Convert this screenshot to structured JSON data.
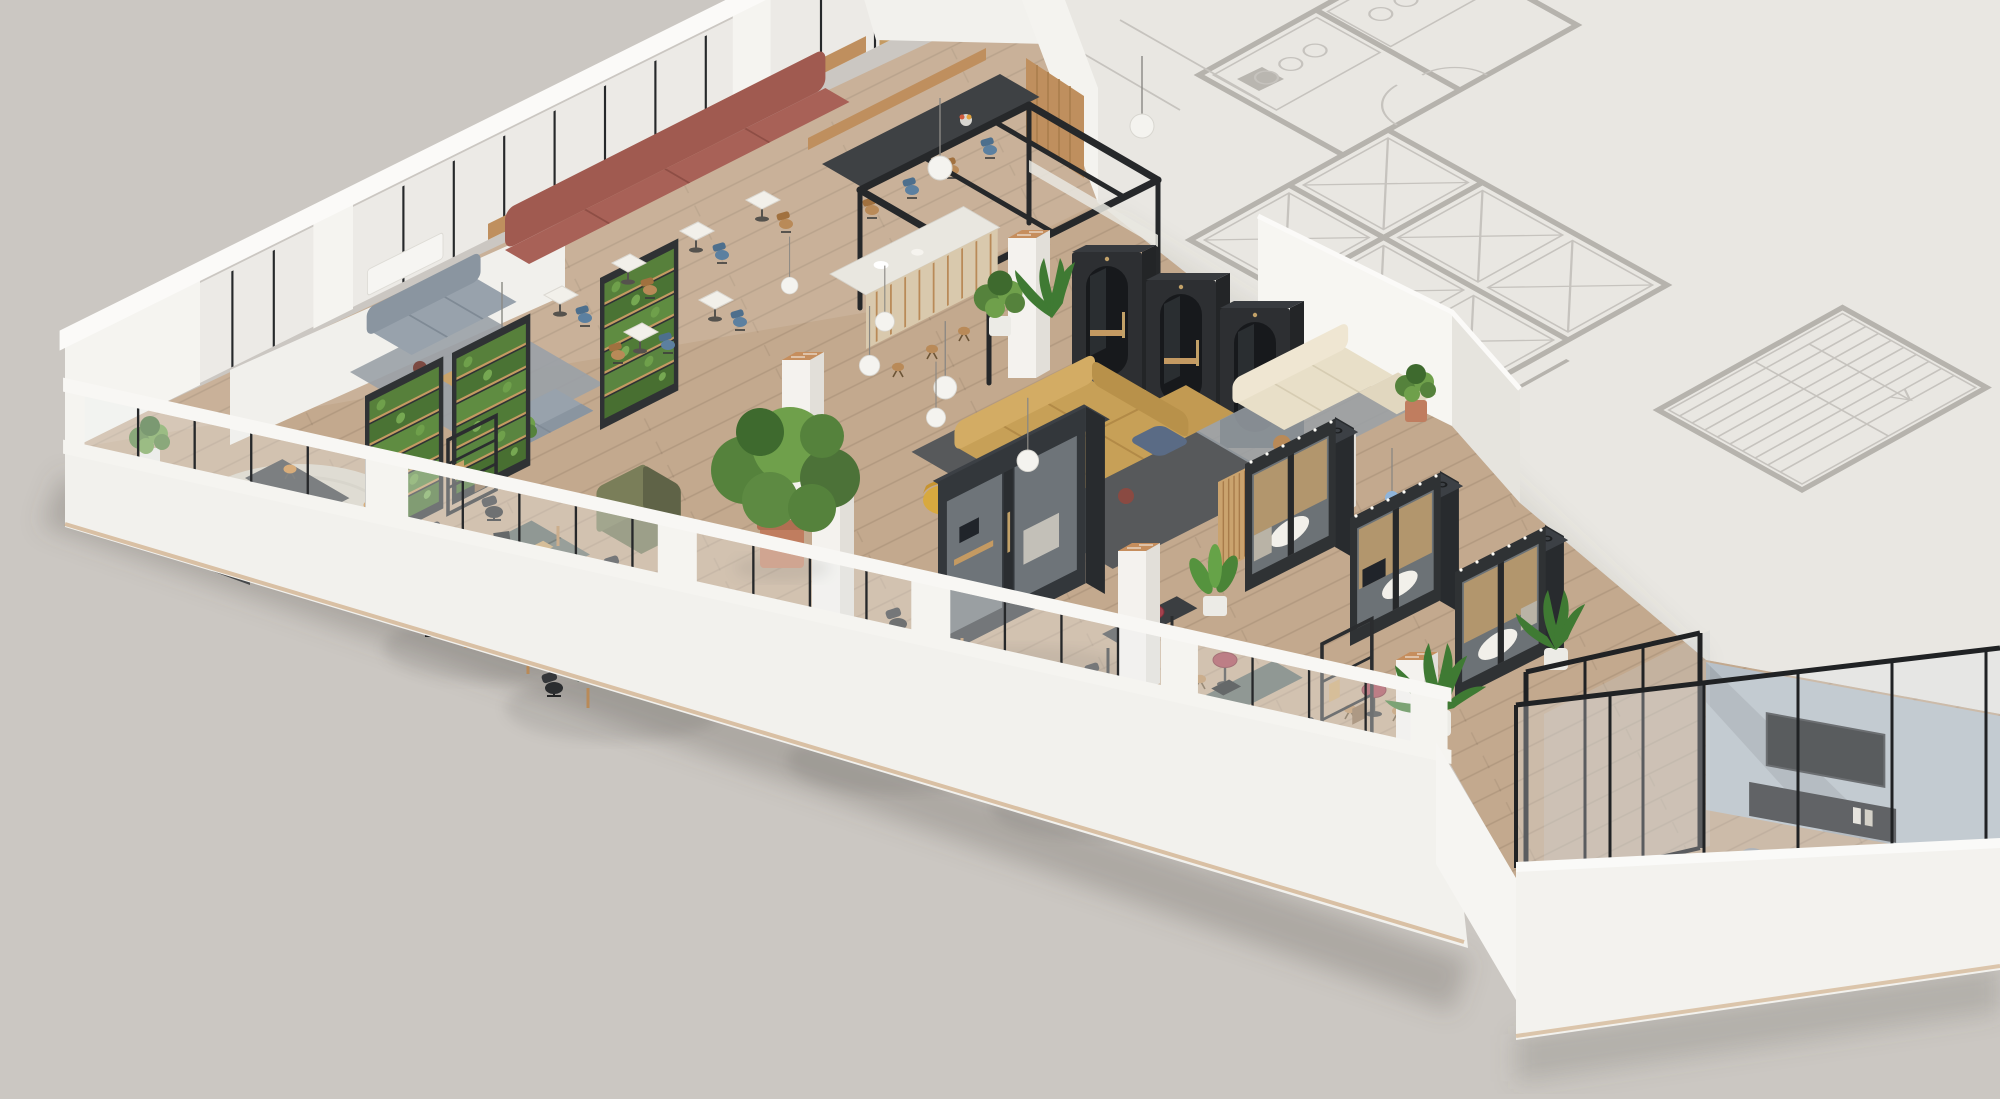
{
  "scene": {
    "title": "Isometric 3D office floor plan render",
    "description": "Cutaway axonometric rendering of a coworking office floor. Rendered furnished area occupies the left and bottom; a faded 2D architectural line plan (elevator core, stair, restrooms) occupies the unbuilt upper-right slab. No text labels appear in the image.",
    "projection": "isometric-cutaway",
    "has_text": false
  },
  "palette": {
    "background": "#cbc7c2",
    "plan_slab": "#e9e7e2",
    "plan_line": "#c6c3be",
    "plan_wall": "#b6b3ad",
    "wall_white": "#f5f4f0",
    "wall_bright": "#fbfaf8",
    "wall_shade": "#e3e1db",
    "glass": "#eef1f2",
    "mullion": "#26282a",
    "floor_wood": "#c3a98e",
    "wood_accent": "#bf8f5e",
    "pod_dark": "#33373b",
    "pod_side": "#282b2e",
    "pod_top": "#3c4045",
    "booth_dark": "#2d2f32",
    "sofa_yellow": "#c7a057",
    "banquette_red": "#a05a50",
    "sofa_cream": "#e8dfc8",
    "sofa_gray": "#98a2ac",
    "chair_olive": "#707452",
    "rug_dark": "#57595b",
    "rug_gray": "#9aa1a7",
    "rug_jute": "#d8d2c3",
    "desk_top": "#5f6963",
    "chair_black": "#2b2d2f",
    "table_red": "#a3414d",
    "stool_orange": "#cd893c",
    "chair_blue": "#5c80a0",
    "plant_green": "#55823c",
    "plant_light": "#6fa04b",
    "plant_dark": "#3e6a2e",
    "pot_terracotta": "#c07d5f",
    "pot_white": "#ecebe6",
    "column_white": "#f4f2ee",
    "column_side": "#e2dfd9",
    "brick_top": "#c68e5d",
    "accent_wall_blue": "#b7c0c8",
    "frame_black": "#202224",
    "marble": "#f2f0ea",
    "terrazzo": "#e9e7e0",
    "tv_black": "#1f2123",
    "pendant_white": "#f4f3ef",
    "pendant_blue": "#9cb9d6"
  },
  "zones": [
    {
      "id": "background-plan",
      "label": "Unbuilt slab with faded architectural plan: elevator bank, stair run, restroom fixtures, door swings"
    },
    {
      "id": "north-facade",
      "label": "Glazed facade with white piers, dark mullions and wood bench rail"
    },
    {
      "id": "south-facade",
      "label": "Cutaway parapet facade with continuous glazing and white piers"
    },
    {
      "id": "east-facade",
      "label": "South-east parapet with black framed glazing of the meeting room"
    },
    {
      "id": "west-nook",
      "label": "Corner huddle space: round jute rug, two standing tables, orange stools, pin board, radiator"
    },
    {
      "id": "gray-lounge",
      "label": "Lounge with two gray sofas, blue-gray rug, coffee table, globe floor lamp"
    },
    {
      "id": "green-walls",
      "label": "Three dark-framed living green wall planters"
    },
    {
      "id": "cafe-banquette",
      "label": "Terracotta banquette with white marble bistro tables, blue and oak chairs"
    },
    {
      "id": "open-kitchen",
      "label": "Black steel pergola kitchen, terrazzo counter on oak slats, bar stools, communal table with bench, globe pendants"
    },
    {
      "id": "phone-booths",
      "label": "Three single phone booths with arched smoked-glass doors and oak ledges"
    },
    {
      "id": "central-lounge",
      "label": "Mustard modular sectional on charcoal rug with blue pouf, yellow easy chair, pendants"
    },
    {
      "id": "focus-pod",
      "label": "Large black glass meeting pod with oak magazine rack and standing counter with stools"
    },
    {
      "id": "pod-row",
      "label": "Row of three black meeting pods with glazed fronts, oak interiors and white tables"
    },
    {
      "id": "cream-lounge",
      "label": "Cream sectional nook on gray rug with black bistro tables, blue glass pendants, white pedestal lamp"
    },
    {
      "id": "open-desks",
      "label": "Four clusters of back-to-back desks, graphite tops, oak legs, black task chairs, monitors"
    },
    {
      "id": "standing-tables",
      "label": "Burgundy poseur tables with oak stools"
    },
    {
      "id": "shelving",
      "label": "Black open shelving units"
    },
    {
      "id": "privacy-chair",
      "label": "Olive high-back privacy armchair"
    },
    {
      "id": "meeting-room",
      "label": "Glazed corner meeting room: blue-gray media wall, TV, credenza, round table, gray chairs, white pendants"
    },
    {
      "id": "columns",
      "label": "White structural columns with exposed brick tops"
    },
    {
      "id": "planting",
      "label": "Potted tree, palms, banana plants and bushes in terracotta and white pots"
    }
  ],
  "objects": {
    "phone_booths": 3,
    "meeting_pods_row": 3,
    "focus_pods": 1,
    "desk_clusters": 4,
    "green_wall_panels": 3,
    "white_columns": 6,
    "standing_tables": 3,
    "sofas": 5,
    "pendant_globes": 8,
    "tv_screens": 1
  }
}
